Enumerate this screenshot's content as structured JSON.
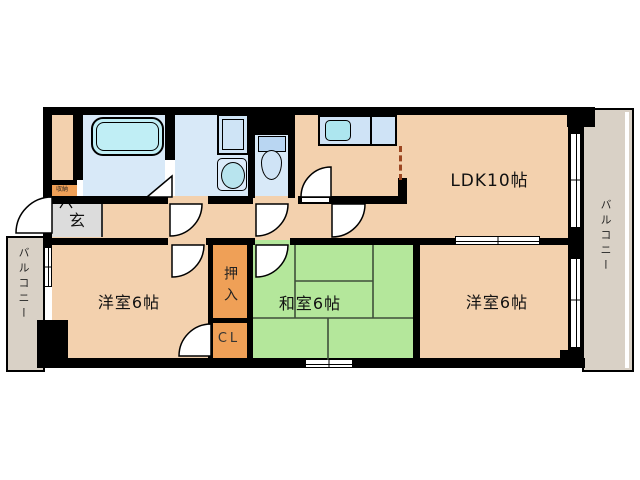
{
  "floorplan": {
    "rooms": {
      "ldk": {
        "label": "LDK10帖"
      },
      "western1": {
        "label": "洋室6帖"
      },
      "japanese": {
        "label": "和室6帖"
      },
      "western2": {
        "label": "洋室6帖"
      },
      "oshiire": {
        "label": "押入"
      },
      "cl": {
        "label": "CL"
      },
      "genkan": {
        "label": "玄"
      },
      "storage": {
        "label": "収納"
      },
      "balcony_left": {
        "label": "バルコニー"
      },
      "balcony_right": {
        "label": "バルコニー"
      }
    },
    "colors": {
      "wall": "#000000",
      "room_floor": "#f3d1ae",
      "tatami_green": "#b4e79b",
      "tatami_line": "#3f4f3a",
      "closet_orange": "#efa057",
      "sanitary_blue": "#d8e9f8",
      "fixture_cyan": "#c0eef5",
      "balcony_gray": "#d9d1c6",
      "entrance_gray": "#dcdcdc",
      "open_partition_dash": "#9c4722"
    },
    "fixtures": [
      "bathtub-icon",
      "washing-machine-pan-icon",
      "washbasin-icon",
      "toilet-icon",
      "kitchen-sink-icon"
    ]
  }
}
